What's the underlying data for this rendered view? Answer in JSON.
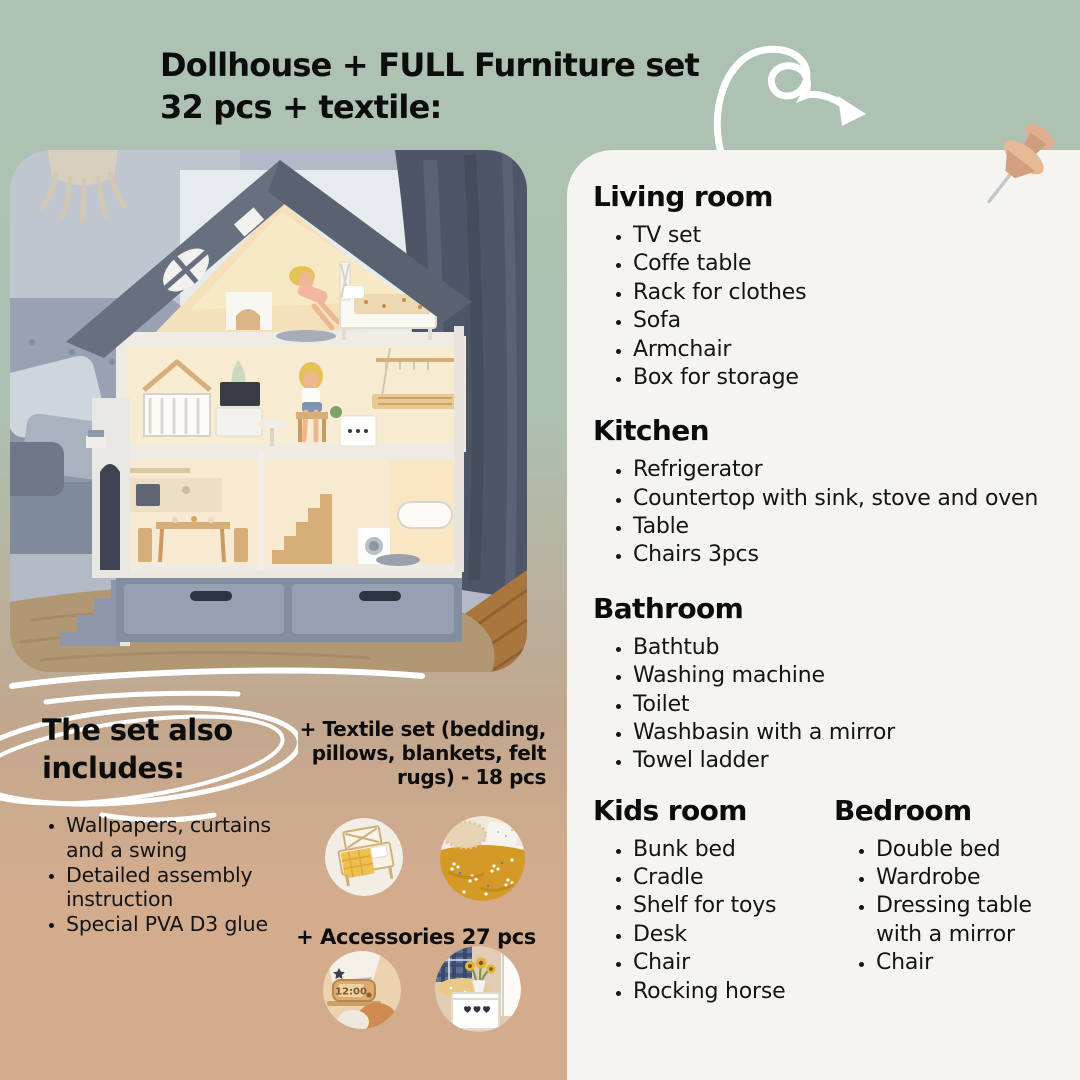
{
  "title": {
    "line1": "Dollhouse + FULL Furniture set",
    "line2": "32 pcs + textile:"
  },
  "colors": {
    "background_top": "#adc2b2",
    "background_bottom": "#d3ac8e",
    "panel": "#f6f4f0",
    "text": "#141414",
    "doodle_white": "#ffffff",
    "pin_tan": "#dfae8c"
  },
  "rooms": [
    {
      "heading": "Living room",
      "items": [
        "TV set",
        "Coffe table",
        "Rack for clothes",
        "Sofa",
        "Armchair",
        "Box for storage"
      ]
    },
    {
      "heading": "Kitchen",
      "items": [
        "Refrigerator",
        "Countertop with sink, stove and oven",
        "Table",
        "Chairs 3pcs"
      ]
    },
    {
      "heading": "Bathroom",
      "items": [
        "Bathtub",
        "Washing machine",
        "Toilet",
        "Washbasin with a mirror",
        "Towel ladder"
      ]
    },
    {
      "heading": "Kids room",
      "items": [
        "Bunk bed",
        "Cradle",
        "Shelf for toys",
        "Desk",
        "Chair",
        "Rocking horse"
      ]
    },
    {
      "heading": "Bedroom",
      "items": [
        "Double bed",
        "Wardrobe",
        "Dressing table with a mirror",
        "Chair"
      ]
    }
  ],
  "includes": {
    "heading": "The set also includes:",
    "items": [
      "Wallpapers, curtains and a swing",
      "Detailed assembly instruction",
      "Special PVA D3 glue"
    ]
  },
  "textile_lines": [
    "+ Textile set (bedding,",
    "pillows, blankets, felt",
    "rugs) - 18 pcs"
  ],
  "accessories_label": "+ Accessories 27 pcs",
  "clock_time": "12:00"
}
